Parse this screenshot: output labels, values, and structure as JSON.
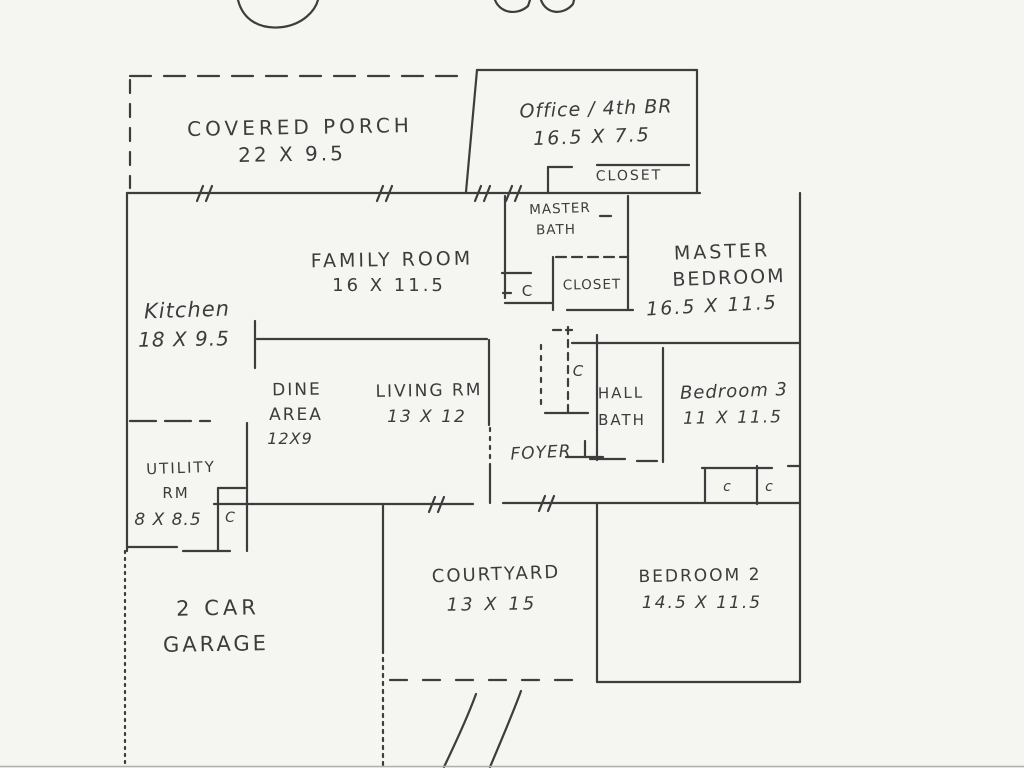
{
  "document": {
    "kind": "hand-drawn residential floor plan (scanned pencil sketch)"
  },
  "colors": {
    "paper": "#f5f5f2",
    "ink": "#3d3d3d",
    "scan_edge": "#b0b0b0"
  },
  "rooms": {
    "covered_porch": {
      "label": "COVERED PORCH",
      "dims": "22 X 9.5"
    },
    "office": {
      "label": "Office / 4th BR",
      "dims": "16.5 X 7.5"
    },
    "office_closet": {
      "label": "CLOSET"
    },
    "family_room": {
      "label": "FAMILY ROOM",
      "dims": "16 X 11.5"
    },
    "master_bath": {
      "line1": "MASTER",
      "line2": "BATH"
    },
    "master_closet": {
      "label": "CLOSET"
    },
    "master_bedroom": {
      "line1": "MASTER",
      "line2": "BEDROOM",
      "dims": "16.5 X 11.5"
    },
    "kitchen": {
      "label": "Kitchen",
      "dims": "18 X 9.5"
    },
    "dine_area": {
      "line1": "DINE",
      "line2": "AREA",
      "dims": "12X9"
    },
    "living_room": {
      "label": "LIVING RM",
      "dims": "13 X 12"
    },
    "hall_bath": {
      "line1": "HALL",
      "line2": "BATH"
    },
    "bedroom3": {
      "label": "Bedroom 3",
      "dims": "11 X 11.5"
    },
    "foyer": {
      "label": "FOYER"
    },
    "utility": {
      "line1": "UTILITY",
      "line2": "RM",
      "dims": "8 X 8.5"
    },
    "garage": {
      "line1": "2 CAR",
      "line2": "GARAGE"
    },
    "courtyard": {
      "label": "COURTYARD",
      "dims": "13 X 15"
    },
    "bedroom2": {
      "label": "BEDROOM 2",
      "dims": "14.5 X 11.5"
    }
  },
  "closet_markers": {
    "master_bath_c": "C",
    "hall_c": "C",
    "utility_c": "C",
    "bedroom_closet_c1": "c",
    "bedroom_closet_c2": "c"
  }
}
